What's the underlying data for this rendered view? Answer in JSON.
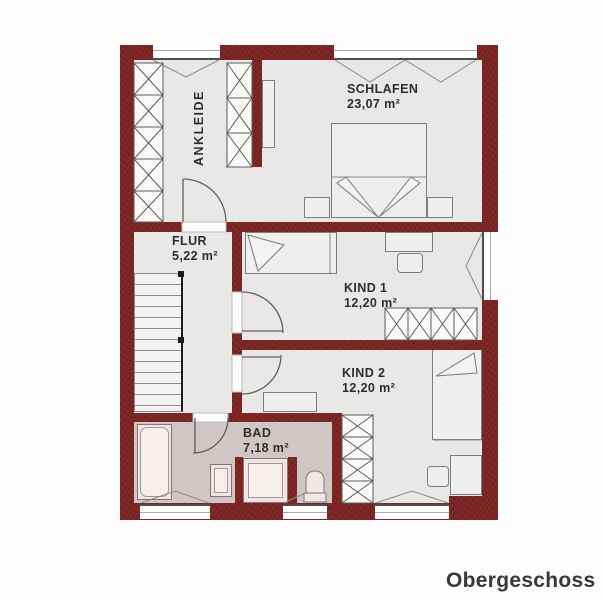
{
  "title": "Obergeschoss",
  "rooms": {
    "ankleide": {
      "name": "ANKLEIDE"
    },
    "schlafen": {
      "name": "SCHLAFEN",
      "area": "23,07 m²"
    },
    "flur": {
      "name": "FLUR",
      "area": "5,22 m²"
    },
    "kind1": {
      "name": "KIND 1",
      "area": "12,20 m²"
    },
    "kind2": {
      "name": "KIND 2",
      "area": "12,20 m²"
    },
    "bad": {
      "name": "BAD",
      "area": "7,18 m²"
    }
  },
  "colors": {
    "wall": "#7b2422",
    "floor": "#e9e8e6",
    "bad_floor": "#cfc6c5",
    "fixture": "#f2e4e4",
    "text": "#2d2d2d"
  }
}
